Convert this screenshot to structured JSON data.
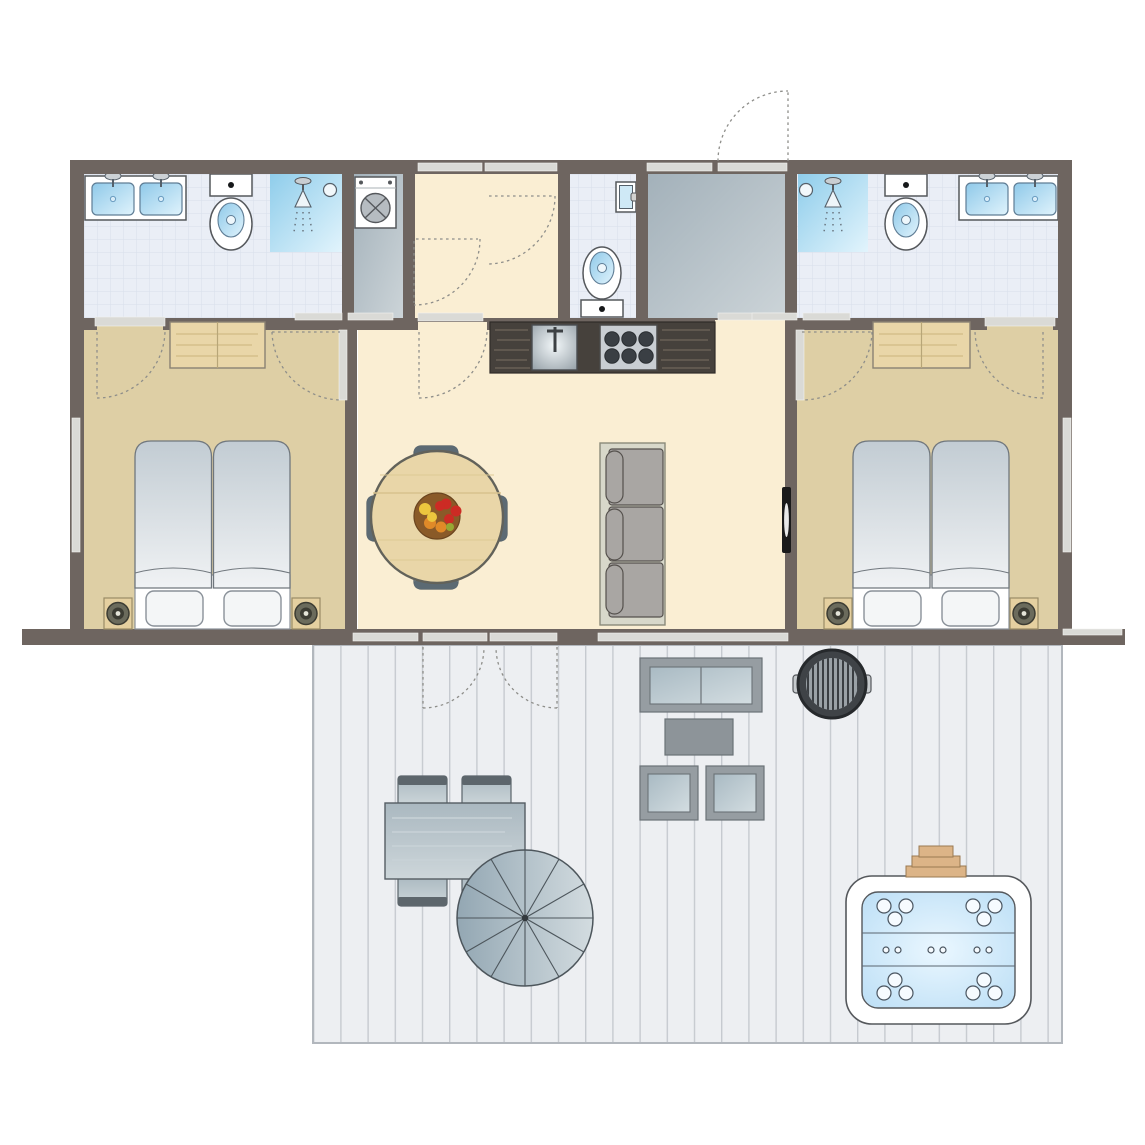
{
  "plan_type": "holiday-home-floor-plan",
  "colors": {
    "wall": "#6e6560",
    "window_bar": "#dadad6",
    "bedroom_floor": "#decfa5",
    "living_floor": "#faeed3",
    "tile_floor": "#eaeef6",
    "gray_room": "#b6c0c6",
    "deck_floor": "#edeff2",
    "shower_blue": "#a9d9f1",
    "water_blue": "#c3e3f8",
    "wood_light": "#e9d6a8",
    "counter_dark": "#46413c",
    "furniture_gray": "#a0aeb8"
  },
  "rooms": {
    "bathroom_left": {
      "name": "bathroom-left",
      "fixtures": [
        "double-washbasin",
        "toilet",
        "shower"
      ]
    },
    "utility": {
      "name": "utility-room",
      "fixtures": [
        "washing-machine"
      ]
    },
    "hallway": {
      "name": "hallway",
      "fixtures": [
        "door-swing",
        "door-swing"
      ]
    },
    "wc": {
      "name": "wc",
      "fixtures": [
        "toilet",
        "small-window"
      ]
    },
    "entrance": {
      "name": "entrance-hall",
      "fixtures": [
        "front-door",
        "sidelight-window"
      ]
    },
    "bathroom_right": {
      "name": "bathroom-right",
      "fixtures": [
        "shower",
        "toilet",
        "double-washbasin"
      ]
    },
    "bedroom_left": {
      "name": "bedroom-left",
      "fixtures": [
        "wardrobe",
        "double-bed",
        "two-pillows",
        "nightstand-lamp-left",
        "nightstand-lamp-right",
        "side-window"
      ]
    },
    "living_kitchen": {
      "name": "living-kitchen",
      "fixtures": [
        "kitchen-counter",
        "kitchen-sink",
        "hob-6-burners",
        "round-dining-table",
        "four-chairs",
        "fruit-bowl",
        "three-seat-sofa",
        "wall-tv",
        "french-doors"
      ]
    },
    "bedroom_right": {
      "name": "bedroom-right",
      "fixtures": [
        "wardrobe",
        "double-bed",
        "two-pillows",
        "nightstand-lamp-left",
        "nightstand-lamp-right",
        "side-window"
      ]
    },
    "deck": {
      "name": "deck-terrace",
      "fixtures": [
        "outdoor-dining-table",
        "four-deck-chairs",
        "parasol-12-segments",
        "lounge-sofa",
        "coffee-table",
        "two-lounge-chairs",
        "barbecue-grill",
        "hot-tub",
        "wooden-step"
      ]
    }
  },
  "counts": {
    "hob_burners": 6,
    "parasol_segments": 12,
    "hot_tub_large_jets": 12,
    "hot_tub_small_jets": 6,
    "hot_tub_seat_rows": 3,
    "dining_chairs_inside": 4,
    "dining_chairs_deck": 4,
    "bedrooms": 2,
    "showers": 2,
    "toilets": 3,
    "washbasins": 4
  }
}
